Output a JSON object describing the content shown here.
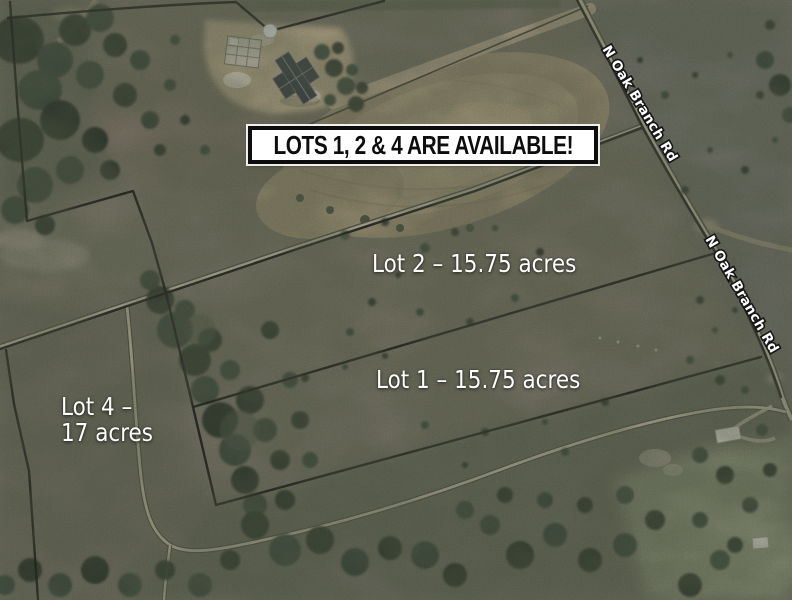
{
  "image": {
    "banner_text": "LOTS 1, 2 & 4 ARE AVAILABLE!",
    "road_name": "N Oak Branch Rd",
    "lot_labels": {
      "lot2": "Lot 2 – 15.75 acres",
      "lot1": "Lot 1 – 15.75 acres",
      "lot4": "Lot 4 –\n17 acres"
    },
    "colors": {
      "banner_background": "#ffffff",
      "banner_border": "#0d0d0d",
      "banner_text": "#0d0d0d",
      "lot_label_text": "#ffffff",
      "road_label_text": "#ffffff",
      "road_label_outline": "#161616",
      "boundary_line": "#161616",
      "road_surface": "#cfc7b0",
      "dirt_field": "#b2a285",
      "terrain_base": "#7e7a6d",
      "trees": "#2b352b",
      "corner_marker": "#ffffff"
    }
  }
}
